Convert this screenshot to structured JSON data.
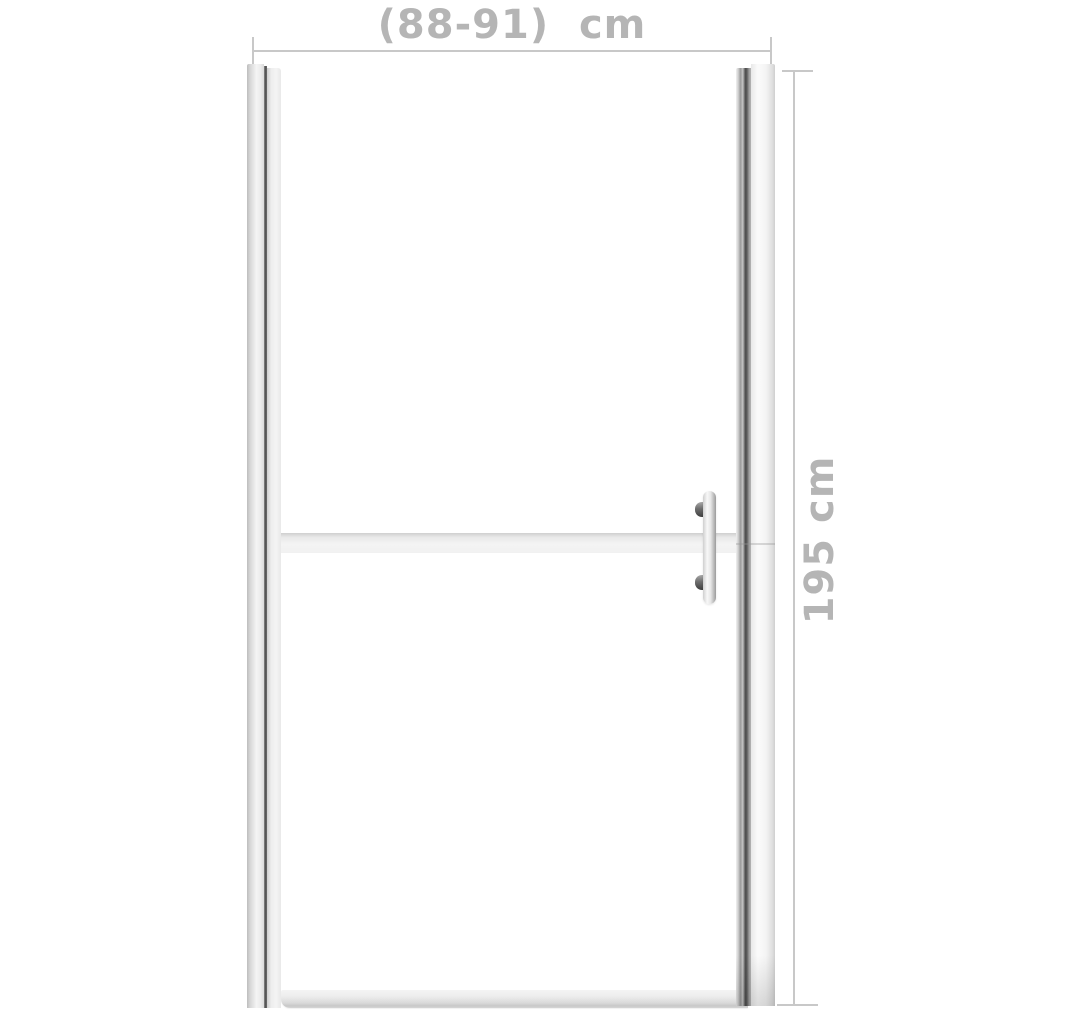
{
  "annotations": {
    "width_label": "(88-91)  cm",
    "height_label": "195 cm"
  },
  "product": {
    "name": "frameless shower door with frosted stripe and bar handle",
    "parts": {
      "left_wall_profile": "silver aluminium profile",
      "right_wall_profile": "silver aluminium profile",
      "frosted_stripe": "horizontal frosted glass band",
      "door_handle": "vertical bar handle with two standoffs",
      "bottom_rail": "bottom threshold rail"
    }
  },
  "colors": {
    "background": "#ffffff",
    "dim_line": "#c8c8c8",
    "dim_text": "#b5b5b5",
    "frame_light": "#f4f4f4",
    "frame_mid": "#c4c4c4",
    "frame_dark": "#4e4e4e",
    "stripe": "#f4f4f4",
    "stripe_edge": "#cfcfcf",
    "handle_light": "#f7f7f7",
    "handle_dark": "#9b9b9b",
    "standoff_dark": "#3f3f3f",
    "rail": "#d9d9d9"
  }
}
